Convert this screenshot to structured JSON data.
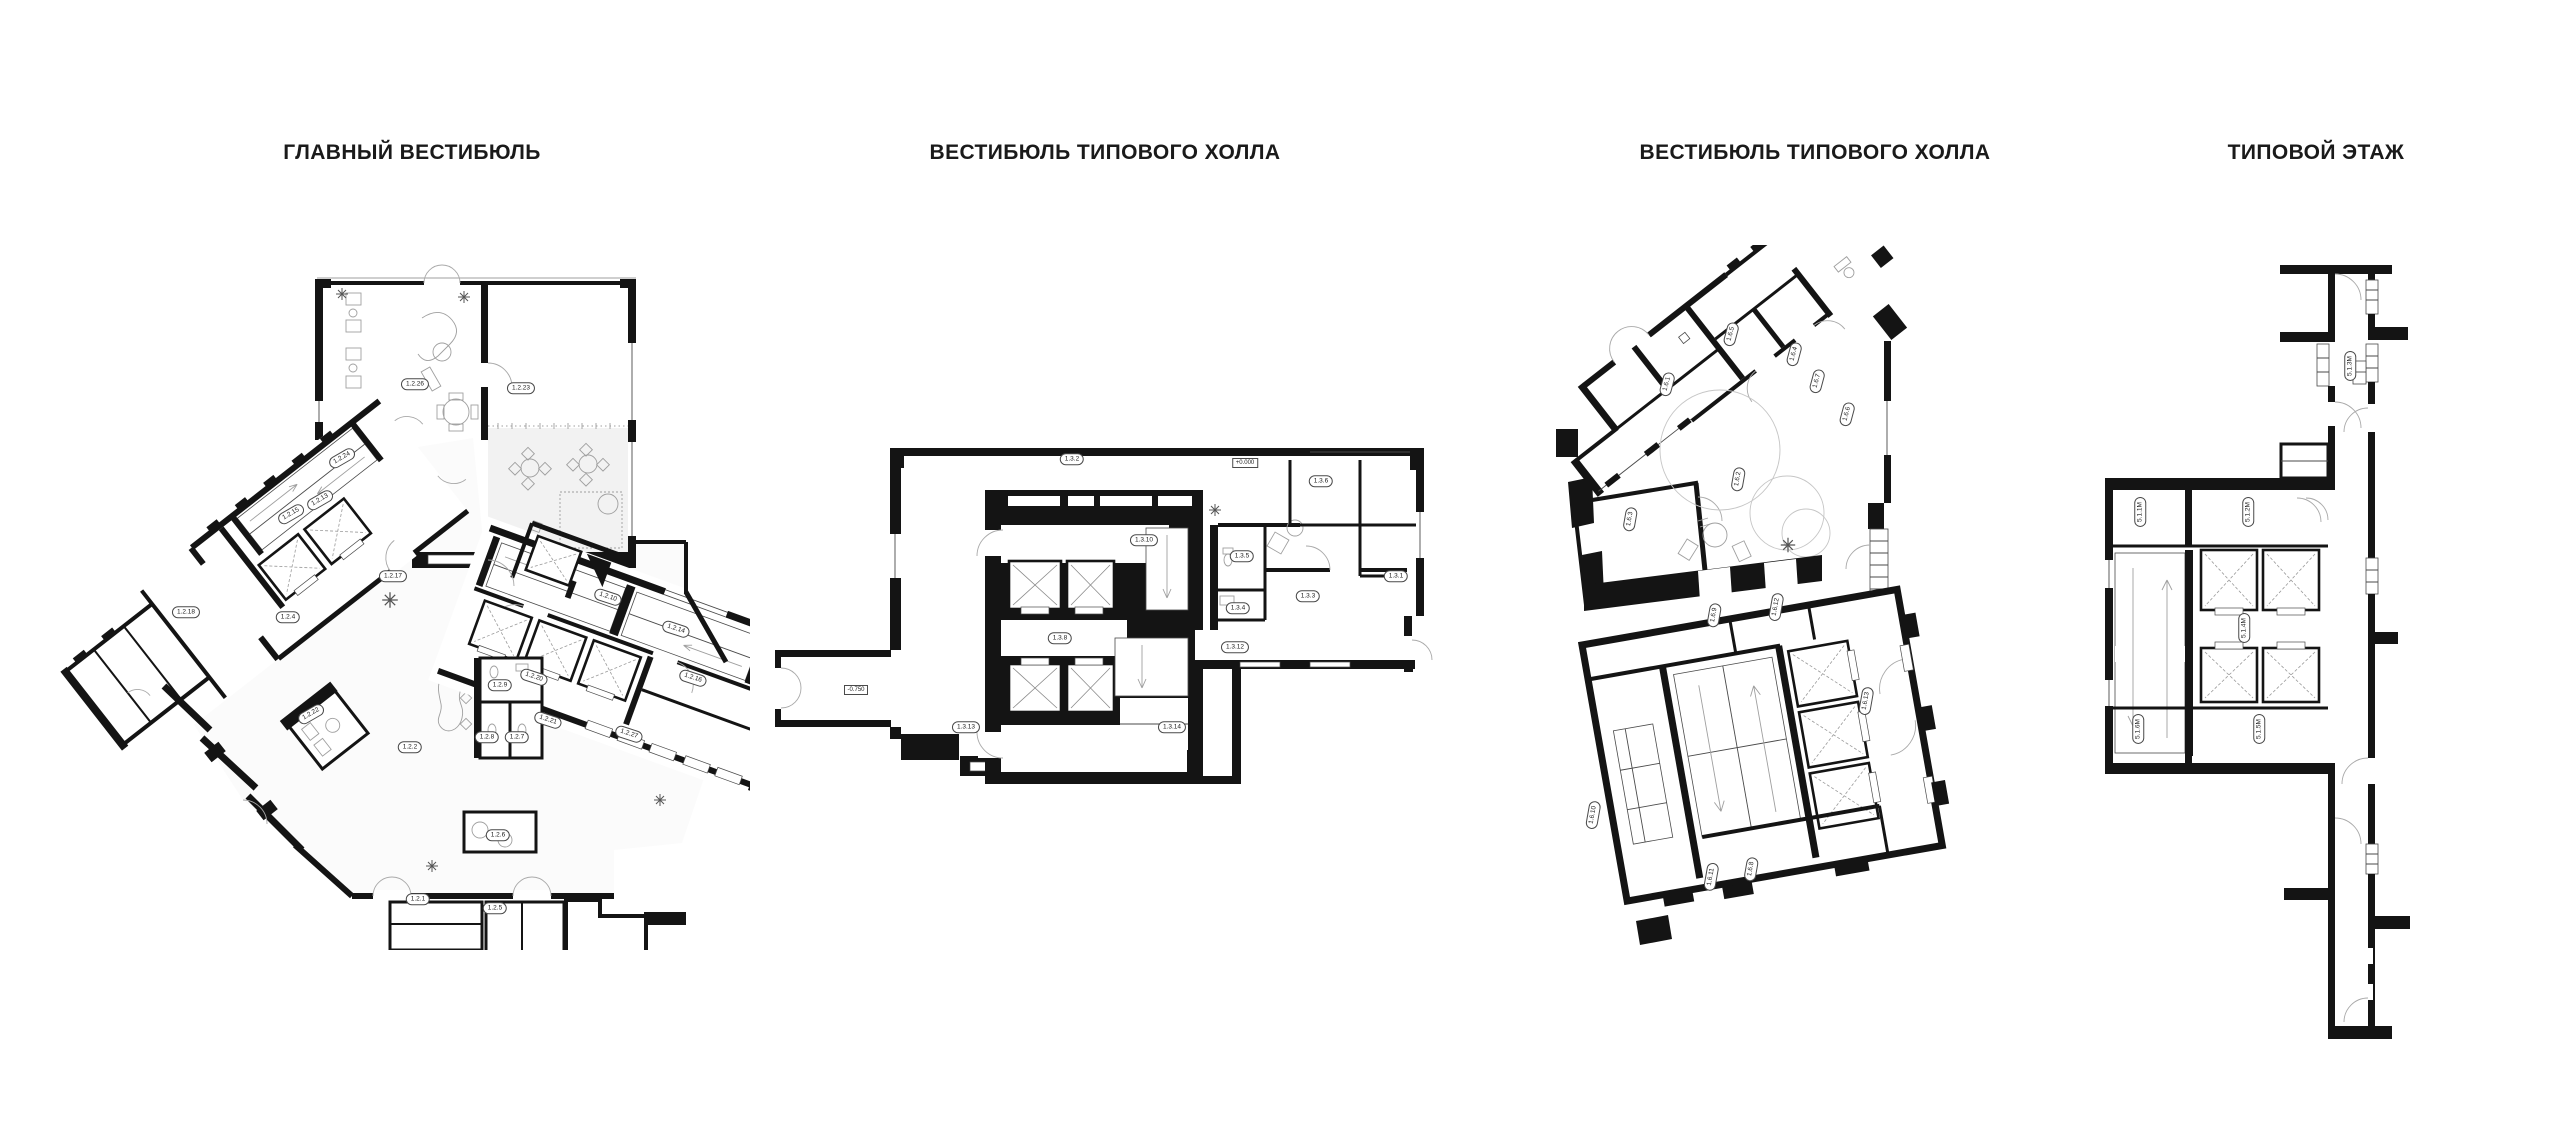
{
  "page": {
    "background": "#ffffff",
    "ink": "#141414",
    "detail_gray": "#9f9f9f"
  },
  "drawing": {
    "kind": "architectural floor plans",
    "sheet_count": 4
  },
  "plans": [
    {
      "id": "main-vestibule",
      "title": "ГЛАВНЫЙ ВЕСТИБЮЛЬ",
      "labels": [
        {
          "t": "1.2.26",
          "x": 415,
          "y": 384,
          "r": 0
        },
        {
          "t": "1.2.23",
          "x": 521,
          "y": 388,
          "r": 0
        },
        {
          "t": "1.2.24",
          "x": 342,
          "y": 458,
          "r": -30
        },
        {
          "t": "1.2.13",
          "x": 320,
          "y": 500,
          "r": -30
        },
        {
          "t": "1.2.15",
          "x": 291,
          "y": 514,
          "r": -30
        },
        {
          "t": "1.2.18",
          "x": 186,
          "y": 612,
          "r": 0
        },
        {
          "t": "1.2.4",
          "x": 288,
          "y": 617,
          "r": 0
        },
        {
          "t": "1.2.17",
          "x": 393,
          "y": 576,
          "r": 0
        },
        {
          "t": "1.2.22",
          "x": 311,
          "y": 714,
          "r": -30
        },
        {
          "t": "1.2.2",
          "x": 410,
          "y": 747,
          "r": 0
        },
        {
          "t": "1.2.10",
          "x": 608,
          "y": 597,
          "r": 18
        },
        {
          "t": "1.2.14",
          "x": 676,
          "y": 629,
          "r": 18
        },
        {
          "t": "1.2.20",
          "x": 534,
          "y": 677,
          "r": 18
        },
        {
          "t": "1.2.16",
          "x": 693,
          "y": 678,
          "r": 18
        },
        {
          "t": "1.2.9",
          "x": 500,
          "y": 685,
          "r": 0
        },
        {
          "t": "1.2.21",
          "x": 548,
          "y": 720,
          "r": 18
        },
        {
          "t": "1.2.27",
          "x": 629,
          "y": 734,
          "r": 18
        },
        {
          "t": "1.2.8",
          "x": 487,
          "y": 737,
          "r": 0
        },
        {
          "t": "1.2.7",
          "x": 517,
          "y": 737,
          "r": 0
        },
        {
          "t": "1.2.6",
          "x": 498,
          "y": 835,
          "r": 0
        },
        {
          "t": "1.2.1",
          "x": 418,
          "y": 899,
          "r": 0
        },
        {
          "t": "1.2.5",
          "x": 495,
          "y": 908,
          "r": 0
        }
      ]
    },
    {
      "id": "typical-hall-vestibule-a",
      "title": "ВЕСТИБЮЛЬ ТИПОВОГО ХОЛЛА",
      "labels": [
        {
          "t": "1.3.2",
          "x": 1072,
          "y": 459,
          "r": 0
        },
        {
          "t": "+0.000",
          "x": 1245,
          "y": 463,
          "r": 0,
          "box": true
        },
        {
          "t": "1.3.6",
          "x": 1321,
          "y": 481,
          "r": 0
        },
        {
          "t": "1.3.10",
          "x": 1144,
          "y": 540,
          "r": 0
        },
        {
          "t": "1.3.5",
          "x": 1242,
          "y": 556,
          "r": 0
        },
        {
          "t": "1.3.1",
          "x": 1396,
          "y": 576,
          "r": 0
        },
        {
          "t": "1.3.3",
          "x": 1308,
          "y": 596,
          "r": 0
        },
        {
          "t": "1.3.4",
          "x": 1238,
          "y": 608,
          "r": 0
        },
        {
          "t": "1.3.8",
          "x": 1060,
          "y": 638,
          "r": 0
        },
        {
          "t": "1.3.12",
          "x": 1235,
          "y": 647,
          "r": 0
        },
        {
          "t": "-0.750",
          "x": 856,
          "y": 690,
          "r": 0,
          "box": true
        },
        {
          "t": "1.3.13",
          "x": 966,
          "y": 727,
          "r": 0
        },
        {
          "t": "1.3.14",
          "x": 1172,
          "y": 727,
          "r": 0
        }
      ]
    },
    {
      "id": "typical-hall-vestibule-b",
      "title": "ВЕСТИБЮЛЬ ТИПОВОГО ХОЛЛА",
      "labels": [
        {
          "t": "1.6.5",
          "x": 1731,
          "y": 334,
          "r": -75
        },
        {
          "t": "1.6.4",
          "x": 1794,
          "y": 354,
          "r": -75
        },
        {
          "t": "1.6.7",
          "x": 1817,
          "y": 381,
          "r": -75
        },
        {
          "t": "1.6.1",
          "x": 1667,
          "y": 384,
          "r": -75
        },
        {
          "t": "1.6.6",
          "x": 1847,
          "y": 414,
          "r": -75
        },
        {
          "t": "1.6.2",
          "x": 1738,
          "y": 479,
          "r": -80
        },
        {
          "t": "1.6.3",
          "x": 1630,
          "y": 519,
          "r": -80
        },
        {
          "t": "1.6.12",
          "x": 1776,
          "y": 607,
          "r": -80
        },
        {
          "t": "1.6.9",
          "x": 1714,
          "y": 615,
          "r": -80
        },
        {
          "t": "1.6.13",
          "x": 1866,
          "y": 701,
          "r": -80
        },
        {
          "t": "1.6.10",
          "x": 1593,
          "y": 815,
          "r": -80
        },
        {
          "t": "1.6.11",
          "x": 1711,
          "y": 877,
          "r": -80
        },
        {
          "t": "1.6.8",
          "x": 1751,
          "y": 869,
          "r": -80
        }
      ]
    },
    {
      "id": "typical-floor",
      "title": "ТИПОВОЙ ЭТАЖ",
      "labels": [
        {
          "t": "5.1.3M",
          "x": 2350,
          "y": 366,
          "r": -90
        },
        {
          "t": "5.1.1M",
          "x": 2140,
          "y": 512,
          "r": -90
        },
        {
          "t": "5.1.2M",
          "x": 2248,
          "y": 512,
          "r": -90
        },
        {
          "t": "5.1.4M",
          "x": 2244,
          "y": 628,
          "r": -90
        },
        {
          "t": "5.1.6M",
          "x": 2138,
          "y": 729,
          "r": -90
        },
        {
          "t": "5.1.5M",
          "x": 2259,
          "y": 729,
          "r": -90
        }
      ]
    }
  ]
}
